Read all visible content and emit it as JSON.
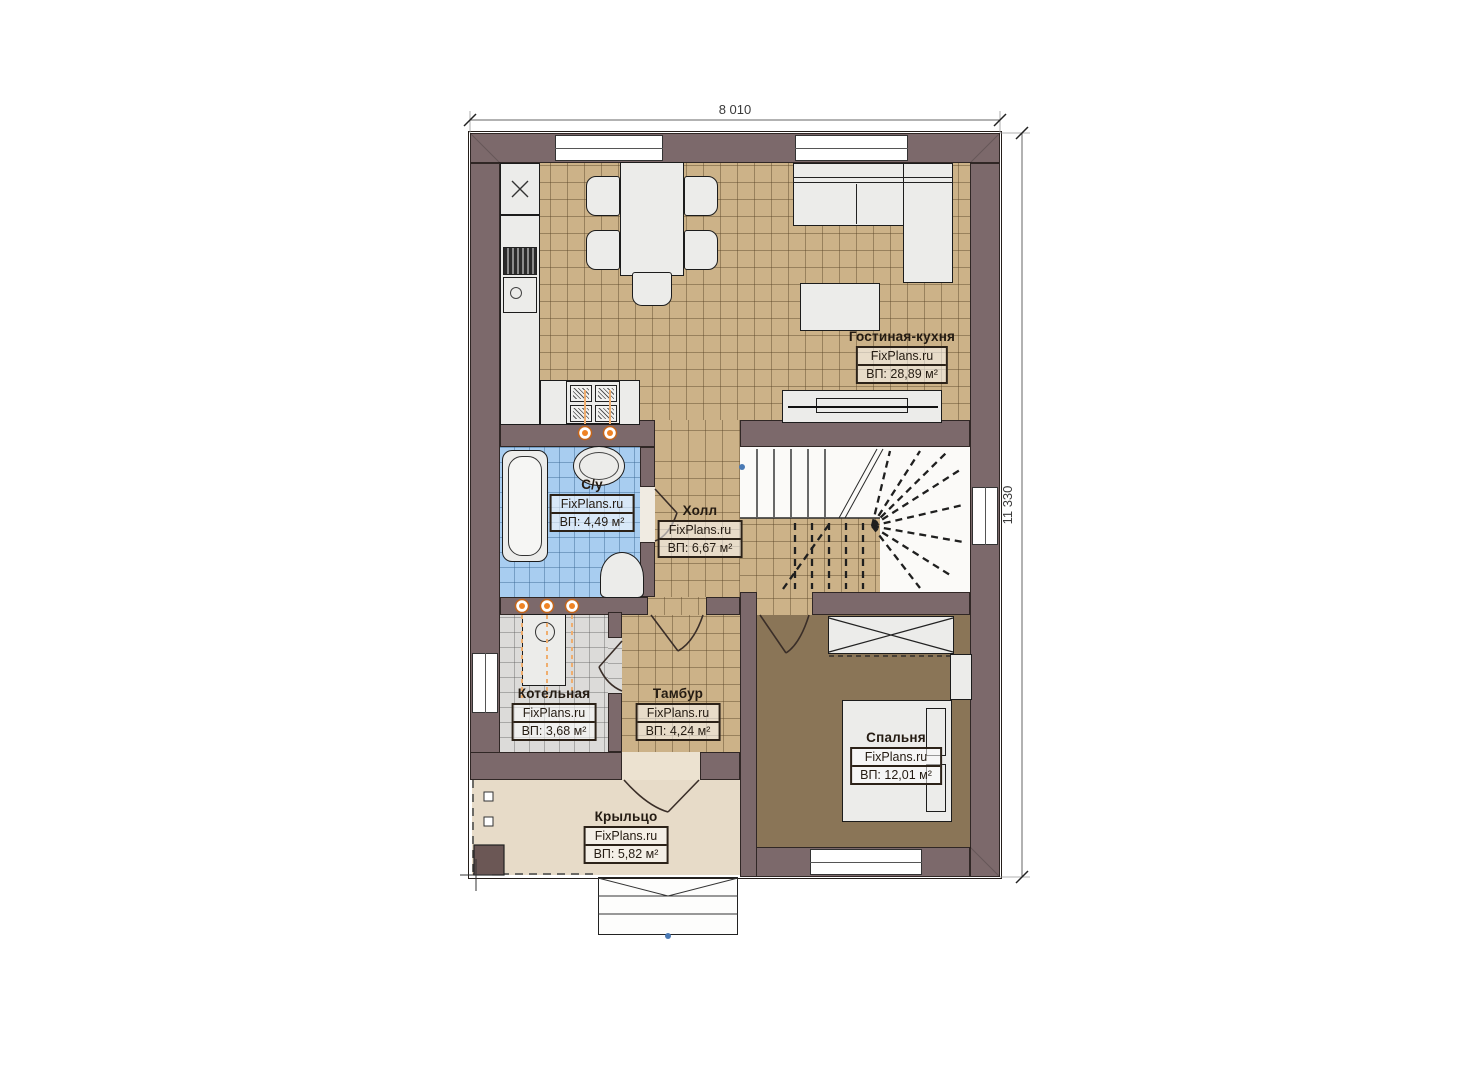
{
  "title": "Floor plan — first floor",
  "dimensions": {
    "width_label": "8 010",
    "height_label": "11 330"
  },
  "rooms": [
    {
      "name": "Гостиная-кухня",
      "brand": "FixPlans.ru",
      "area": "ВП: 28,89 м²"
    },
    {
      "name": "С/у",
      "brand": "FixPlans.ru",
      "area": "ВП: 4,49 м²"
    },
    {
      "name": "Холл",
      "brand": "FixPlans.ru",
      "area": "ВП: 6,67 м²"
    },
    {
      "name": "Котельная",
      "brand": "FixPlans.ru",
      "area": "ВП: 3,68 м²"
    },
    {
      "name": "Тамбур",
      "brand": "FixPlans.ru",
      "area": "ВП: 4,24 м²"
    },
    {
      "name": "Спальня",
      "brand": "FixPlans.ru",
      "area": "ВП: 12,01 м²"
    },
    {
      "name": "Крыльцо",
      "brand": "FixPlans.ru",
      "area": "ВП: 5,82 м²"
    }
  ],
  "colors": {
    "wall": "#7c696b",
    "tile_tan": "#ccb288",
    "tile_blue": "#a8cdf0",
    "tile_gray": "#dcdbd9",
    "floor_bedroom": "#8a7557",
    "floor_porch": "#e7dbc8",
    "accent_orange": "#ef8324",
    "outline": "#241e1a"
  }
}
